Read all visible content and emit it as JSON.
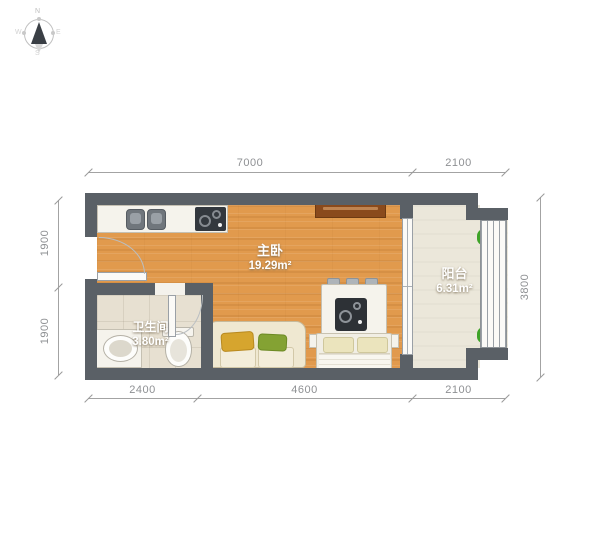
{
  "compass": {
    "n": "N",
    "e": "E",
    "s": "S",
    "w": "W"
  },
  "rooms": {
    "bedroom": {
      "name": "主卧",
      "area": "19.29m²"
    },
    "bathroom": {
      "name": "卫生间",
      "area": "3.80m²"
    },
    "balcony": {
      "name": "阳台",
      "area": "6.31m²"
    }
  },
  "dimensions": {
    "top": [
      "7000",
      "2100"
    ],
    "bottom": [
      "2400",
      "4600",
      "2100"
    ],
    "left": [
      "1900",
      "1900"
    ],
    "right": [
      "3800"
    ]
  },
  "colors": {
    "wall": "#5a6066",
    "bedroom_floor": "#e19a4d",
    "bathroom_floor": "#e7e0d1",
    "balcony_floor": "#ebe7da",
    "tv_cabinet": "#8a4a1c",
    "sofa": "#efe8d1",
    "pillow_yellow": "#d6a52e",
    "pillow_green": "#84a233",
    "plant": "#3ea327",
    "dimension_text": "#8e9093"
  }
}
